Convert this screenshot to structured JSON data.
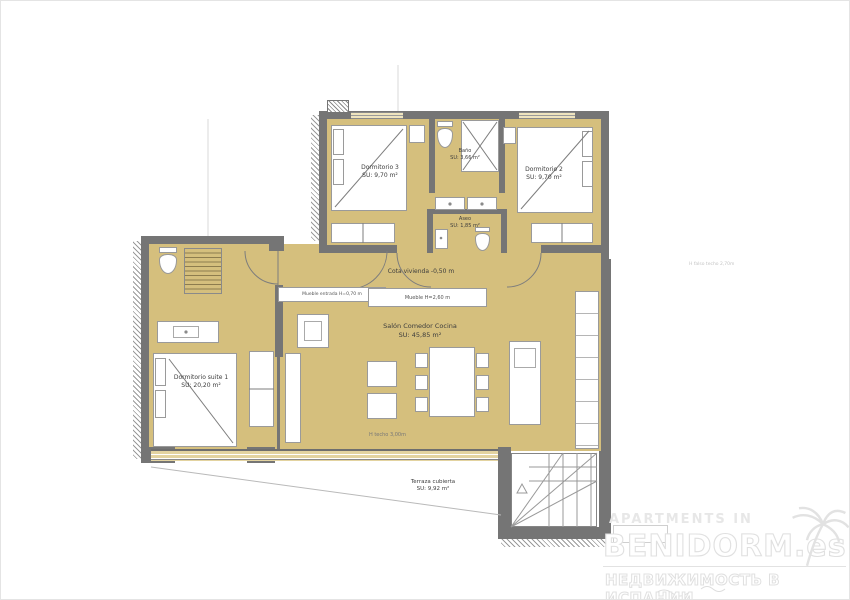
{
  "plan": {
    "rooms": [
      {
        "name": "Dormitorio 3",
        "area": "SU: 9,70 m²"
      },
      {
        "name": "Baño",
        "area": "SU: 3,66 m²"
      },
      {
        "name": "Dormitorio 2",
        "area": "SU: 9,70 m²"
      },
      {
        "name": "Aseo",
        "area": "SU: 1,85 m²"
      },
      {
        "name": "Salón Comedor Cocina",
        "area": "SU: 45,85 m²"
      },
      {
        "name": "Dormitorio suite 1",
        "area": "SU: 20,20 m²"
      },
      {
        "name": "Terraza cubierta",
        "area": "SU: 9,92 m²"
      }
    ],
    "annotations": {
      "cota_vivienda": "Cota vivienda -0,50 m",
      "mueble_entrada": "Mueble entrada H=0,70 m",
      "mueble": "Mueble H=2,60 m",
      "h_techo": "H techo 3,00m",
      "h_falso_techo": "H falso techo 2,70m"
    },
    "colors": {
      "floor": "#d5bf7d",
      "wall": "#757575",
      "window_band": "#e3d3a0",
      "watermark": "#e0e0e0"
    }
  },
  "watermark": {
    "line1": "APARTMENTS IN",
    "line2": "BENIDORM.es",
    "line3": "НЕДВИЖИМОСТЬ В ИСПАНИИ"
  }
}
